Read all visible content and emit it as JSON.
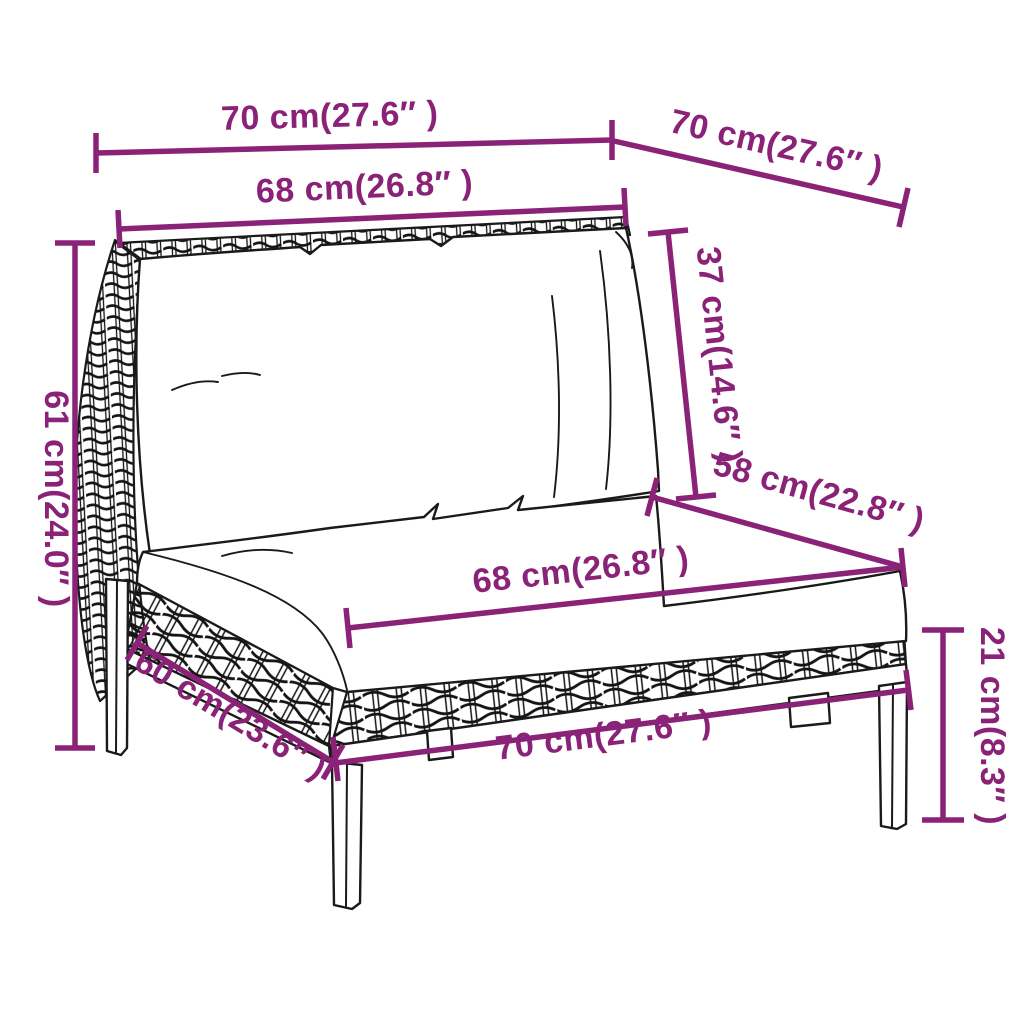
{
  "diagram": {
    "type": "product-dimension-diagram",
    "subject": "half-round poly-rattan garden sofa middle section with back and seat cushions",
    "accent_color": "#8a2277",
    "line_color": "#1a1a1a",
    "background_color": "#ffffff",
    "dimensions": [
      {
        "id": "top-width",
        "label": "70 cm(27.6″ )"
      },
      {
        "id": "top-depth",
        "label": "70 cm(27.6″ )"
      },
      {
        "id": "back-cushion-width",
        "label": "68 cm(26.8″ )"
      },
      {
        "id": "back-cushion-height",
        "label": "37 cm(14.6″ )"
      },
      {
        "id": "overall-height",
        "label": "61 cm(24.0″ )"
      },
      {
        "id": "seat-depth",
        "label": "58 cm(22.8″ )"
      },
      {
        "id": "seat-cushion-width",
        "label": "68 cm(26.8″ )"
      },
      {
        "id": "base-depth",
        "label": "60 cm(23.6″ )"
      },
      {
        "id": "base-width",
        "label": "70 cm(27.6″ )"
      },
      {
        "id": "leg-height",
        "label": "21 cm(8.3″ )"
      }
    ]
  }
}
